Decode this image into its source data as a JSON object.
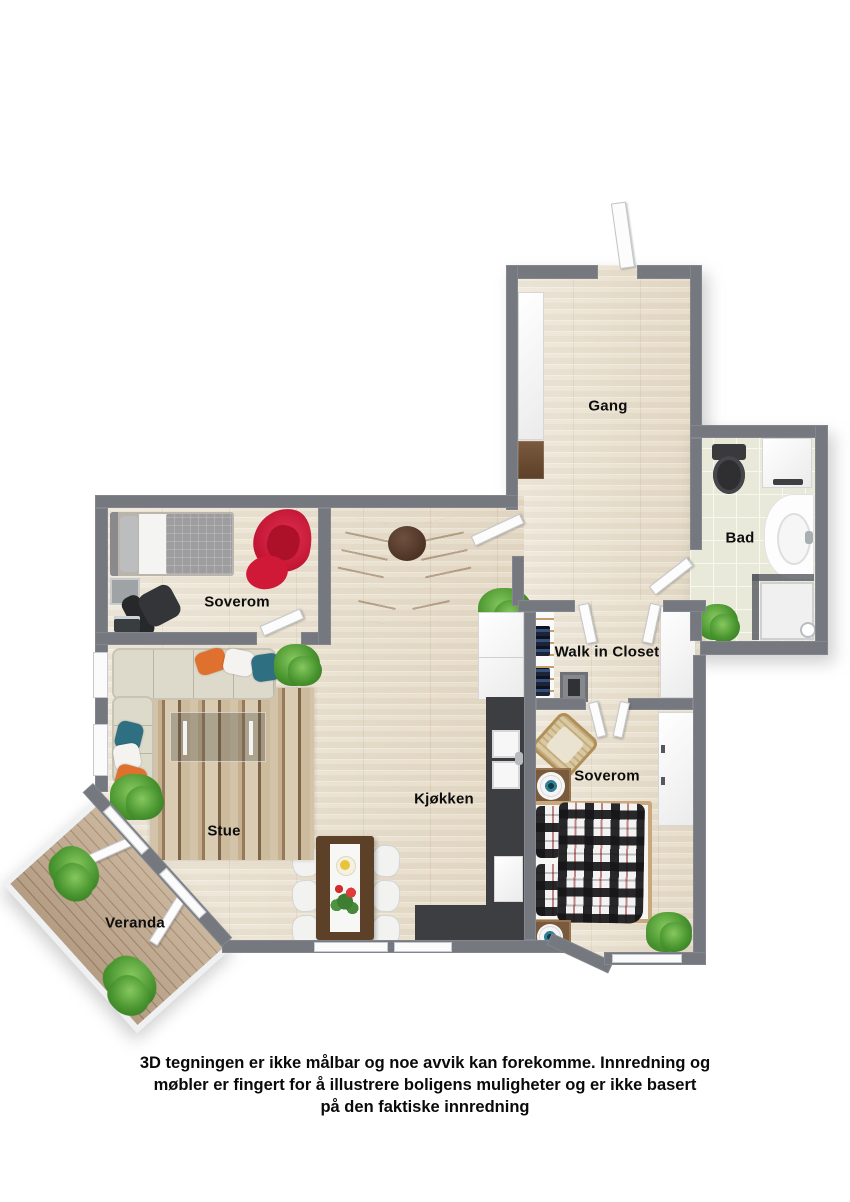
{
  "plan_type": "3D floor plan, top-down view",
  "rooms": [
    {
      "name": "gang",
      "label": "Gang"
    },
    {
      "name": "bad",
      "label": "Bad"
    },
    {
      "name": "soverom-1",
      "label": "Soverom"
    },
    {
      "name": "walk-in-closet",
      "label": "Walk in Closet"
    },
    {
      "name": "soverom-2",
      "label": "Soverom"
    },
    {
      "name": "kjokken",
      "label": "Kjøkken"
    },
    {
      "name": "stue",
      "label": "Stue"
    },
    {
      "name": "veranda",
      "label": "Veranda"
    }
  ],
  "furniture": {
    "gang": [
      "white wardrobe",
      "dresser"
    ],
    "bad": [
      "toilet",
      "washing machine",
      "vanity with sink",
      "corner shower",
      "plant"
    ],
    "soverom-1": [
      "single bed",
      "nightstand",
      "office chair",
      "laptop",
      "red armchair",
      "red ottoman"
    ],
    "walk-in-closet": [
      "clothes shelving",
      "safe",
      "white cabinet"
    ],
    "soverom-2": [
      "double bed with plaid cover",
      "two nightstands with speakers",
      "wicker chair",
      "wardrobe",
      "plant"
    ],
    "kjokken": [
      "fridge cabinet",
      "dark counter with double sink",
      "appliance front",
      "corner counter",
      "dining table with six chairs"
    ],
    "stue": [
      "corner sofa with pillows",
      "striped rug",
      "glass coffee table",
      "plants"
    ],
    "veranda": [
      "wood deck",
      "railing",
      "two plants"
    ]
  },
  "palette": {
    "wall": "#75797F",
    "wood_floor": "#ECE4D3",
    "tile_floor": "#E9E9DA",
    "deck": "#C3AA8E",
    "counter_dark": "#3C3E41",
    "sofa_beige": "#DEDACB",
    "accent_orange": "#D8803F",
    "accent_red": "#D8203F",
    "accent_teal": "#2E6F82",
    "plant_green": "#49952F",
    "label_text": "#0D0D0D"
  },
  "disclaimer": {
    "lines": [
      "3D tegningen er ikke målbar og noe avvik kan forekomme. Innredning og",
      "møbler er fingert for å illustrere boligens muligheter og er ikke basert",
      "på den faktiske innredning"
    ]
  }
}
